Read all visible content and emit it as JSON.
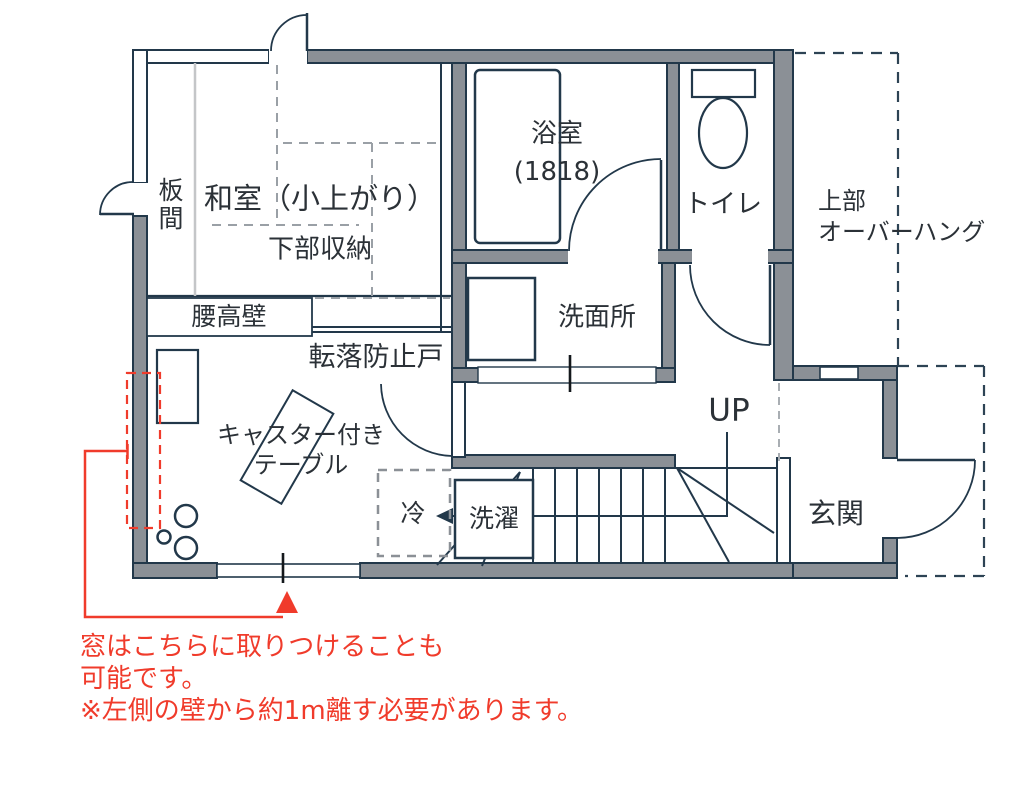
{
  "labels": {
    "washitsu": "和室（小上がり）",
    "lower_storage": "下部収納",
    "itama": "板間",
    "koshitaka_wall": "腰高壁",
    "fall_prevention_door": "転落防止戸",
    "bath_name": "浴室",
    "bath_size": "(1818)",
    "toilet": "トイレ",
    "overhang_line1": "上部",
    "overhang_line2": "オーバーハング",
    "washroom": "洗面所",
    "up": "UP",
    "genkan": "玄関",
    "caster_line1": "キャスター付き",
    "caster_line2": "テーブル",
    "fridge": "冷",
    "laundry": "洗濯"
  },
  "note": {
    "line1": "窓はこちらに取りつけることも",
    "line2": "可能です。",
    "line3": "※左側の壁から約1m離す必要があります。"
  },
  "colors": {
    "wall_fill": "#8b9096",
    "line_navy": "#22384a",
    "dash_gray": "#9aa0a6",
    "overhang_dash": "#2d4354",
    "annotation_red": "#f03b2b"
  }
}
